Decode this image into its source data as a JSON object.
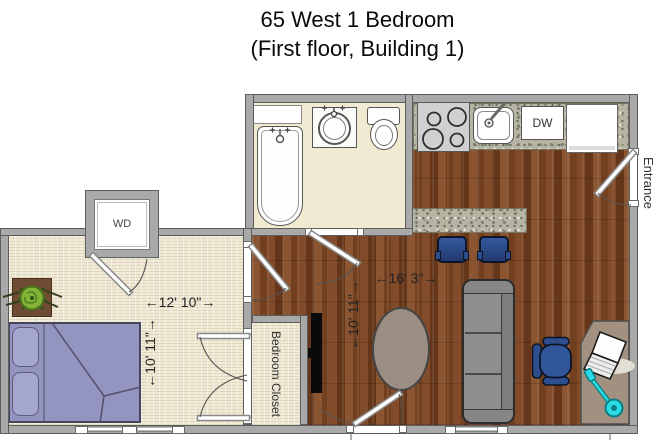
{
  "title": {
    "line1": "65 West 1 Bedroom",
    "line2": "(First floor, Building 1)"
  },
  "labels": {
    "washer_dryer": "WD",
    "dishwasher": "DW",
    "bedroom_closet": "Bedroom Closet",
    "entrance": "Entrance"
  },
  "dimensions": {
    "bedroom_width": "←12' 10\"→",
    "bedroom_depth": "←10' 11\"→",
    "living_width": "←16' 3\"→",
    "living_depth": "←10' 11\"→"
  },
  "colors": {
    "wall": "#a9a9a9",
    "wood_floor": "#7a4526",
    "cream_floor": "#f1ead2",
    "granite": "#b7b4a3",
    "bed": "#9394bf",
    "blue_furniture": "#2d4f8e",
    "sofa": "#8f8f8f",
    "desk": "#a29181",
    "accent_teal": "#2adce3"
  }
}
